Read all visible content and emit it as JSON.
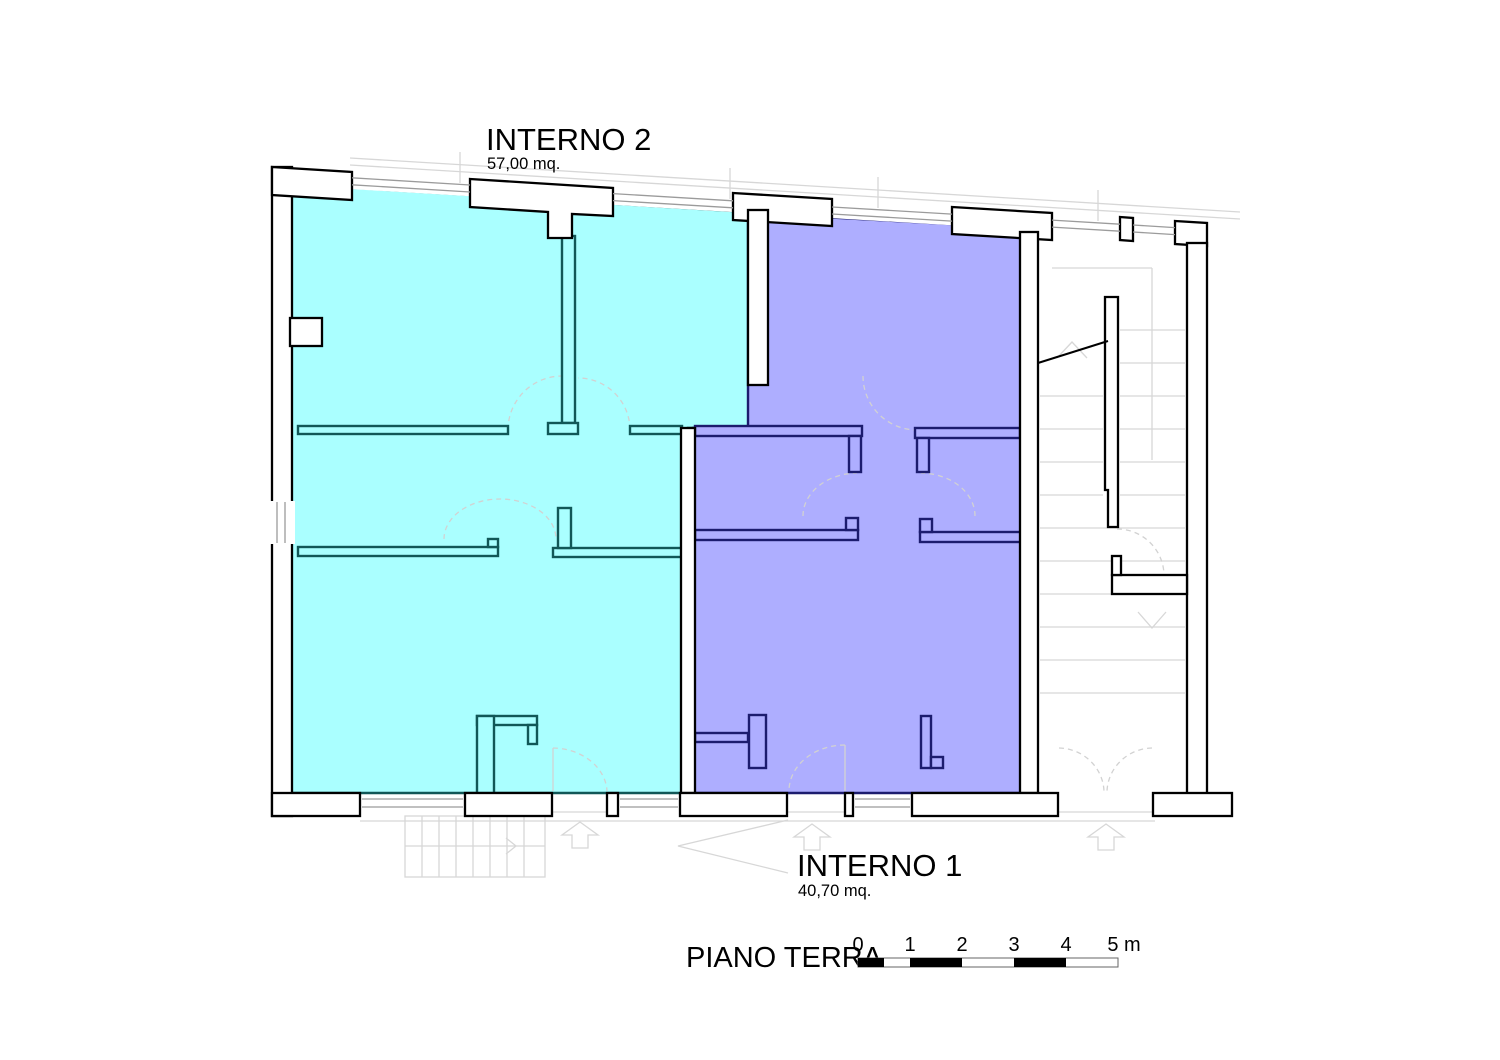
{
  "plan": {
    "floor_label": "PIANO TERRA",
    "apartments": [
      {
        "id": "interno2",
        "title": "INTERNO 2",
        "area": "57,00 mq.",
        "fill": "#aaffff",
        "wall": "#115757"
      },
      {
        "id": "interno1",
        "title": "INTERNO 1",
        "area": "40,70 mq.",
        "fill": "#aeaeff",
        "wall": "#1c1c6e"
      }
    ]
  },
  "scale_bar": {
    "ticks": [
      "0",
      "1",
      "2",
      "3",
      "4"
    ],
    "end_label": "5 m"
  },
  "colors": {
    "background": "#ffffff",
    "wall_fill": "#ffffff",
    "wall_outline": "#000000",
    "faint": "#d7d7d7",
    "arc": "#d2d2d2",
    "glazing": "#9b9b9b",
    "scale_black": "#000000",
    "text": "#000000"
  }
}
